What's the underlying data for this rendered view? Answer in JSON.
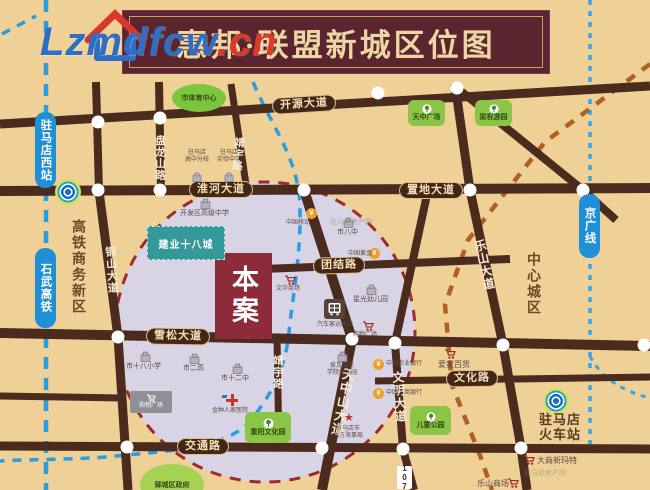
{
  "title": "惠邦·联盟新城区位图",
  "watermark": {
    "blue": "Lzmdfcw",
    "red": ".cn"
  },
  "site_label": "本案",
  "jianye_label": "建业十八城",
  "badge_107": "107",
  "faint_mark": "驻马店房产网",
  "plaques": [
    {
      "label": "开源大道"
    },
    {
      "label": "淮河大道"
    },
    {
      "label": "置地大道"
    },
    {
      "label": "团结路"
    },
    {
      "label": "雪松大道"
    },
    {
      "label": "文化路"
    },
    {
      "label": "交通路"
    }
  ],
  "vroads": [
    {
      "label": "盘龙山路"
    },
    {
      "label": "靖宇路"
    },
    {
      "label": "铜山大道"
    },
    {
      "label": "天中山大道"
    },
    {
      "label": "靖宇路"
    },
    {
      "label": "文明大道"
    },
    {
      "label": "乐山大道"
    }
  ],
  "rail_pills": [
    {
      "label": "驻马店西站"
    },
    {
      "label": "石武高铁"
    },
    {
      "label": "京广线"
    }
  ],
  "areas": [
    {
      "label": "高铁商务新区"
    },
    {
      "label": "中心城区"
    }
  ],
  "station": {
    "line1": "驻马店",
    "line2": "火车站"
  },
  "parks": [
    {
      "label": "天中广场"
    },
    {
      "label": "梁祝游园"
    },
    {
      "label": "重阳文化园"
    },
    {
      "label": "儿童公园"
    },
    {
      "label": "市体育中心"
    },
    {
      "label": "驿城区政府"
    }
  ],
  "schools": [
    {
      "label": "驻马店\n高中分校"
    },
    {
      "label": "驻马店\n实验中学"
    },
    {
      "label": "开发区高级中学"
    },
    {
      "label": "市八中"
    },
    {
      "label": "星光幼儿园"
    },
    {
      "label": "市十八小学"
    },
    {
      "label": "市二高"
    },
    {
      "label": "市十二中"
    },
    {
      "label": "爱克莱斯\n学院幼儿园"
    }
  ],
  "shops": [
    {
      "label": "爱家百货"
    },
    {
      "label": "大商新玛特"
    },
    {
      "label": "乐山商场"
    },
    {
      "label": "购物广场"
    },
    {
      "label": "购物广场"
    },
    {
      "label": "文华商场"
    }
  ],
  "banks": [
    {
      "label": "中国移动"
    },
    {
      "label": "中国黄金"
    },
    {
      "label": "中国农业银行"
    },
    {
      "label": "中国工商银行"
    }
  ],
  "pois": [
    {
      "label": "汽车客运西站"
    },
    {
      "label": "金种人家医院"
    },
    {
      "label": "驻马店市\n地方海事局"
    }
  ]
}
